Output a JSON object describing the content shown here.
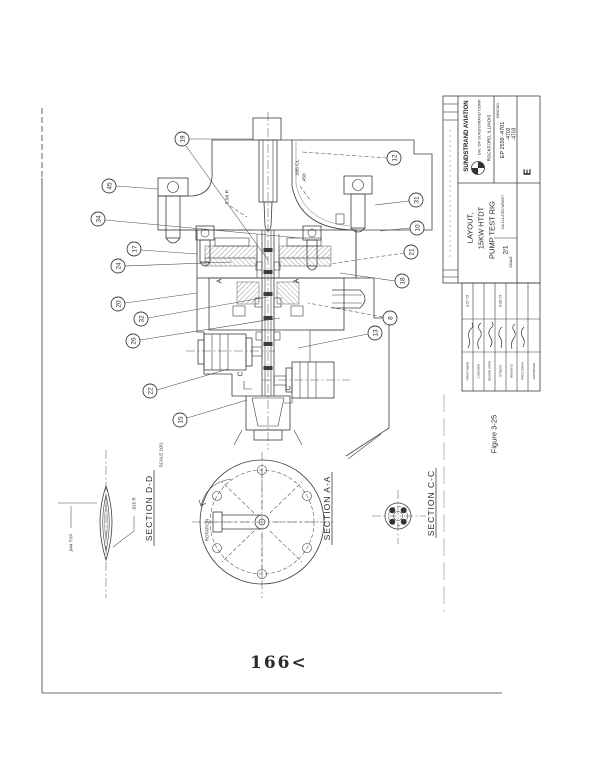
{
  "page": {
    "number": "166<",
    "figure_caption": "Figure 3-25"
  },
  "drawing": {
    "title_block": {
      "company": "SUNDSTRAND AVIATION",
      "division": "DIV. OF SUNDSTRAND CORP.",
      "location": "ROCKFORD, ILLINOIS",
      "dwg_no_label": "DWG NO.",
      "dwg_no": "EP 2559 -4701",
      "dwg_no_2": "-4702",
      "dwg_no_3": "-4703",
      "size": "E",
      "title_line_1": "LAYOUT,",
      "title_line_2": "15KW HTDT",
      "title_line_3": "PUMP TEST RIG",
      "weight_label": "CALCULATED WEIGHT",
      "scale_label": "SCALE",
      "scale_value": "2/1"
    },
    "approvals": {
      "row_labels": [
        "DRAFTSMAN",
        "CHECKER",
        "DESIGN APPD",
        "STRESS",
        "WEIGHTS",
        "PROJ ENGR",
        "APPROVED"
      ],
      "dates": [
        "2-27-73",
        "6-25-73"
      ]
    },
    "annotations": {
      "radius_note": "5.00 R",
      "clearance_note": ".005 CL",
      "dim_note": ".450",
      "cut_a": "A",
      "cut_c": "C"
    },
    "sections": {
      "dd": {
        "title": "SECTION D-D",
        "scale": "SCALE 10/1",
        "dim_typ": ".044 TYP",
        "dim_r": ".015 R"
      },
      "aa": {
        "title": "SECTION A-A",
        "rotation_label": "ROTATION"
      },
      "cc": {
        "title": "SECTION C-C"
      }
    },
    "balloons": {
      "left": [
        "45",
        "34",
        "17",
        "24",
        "20",
        "32",
        "26",
        "22",
        "15"
      ],
      "top": [
        "19"
      ],
      "right": [
        "12",
        "31",
        "10",
        "21",
        "18",
        "8",
        "13"
      ]
    }
  },
  "colors": {
    "ink": "#2b2b2b",
    "line": "#3d3d3d",
    "paper": "#ffffff"
  }
}
